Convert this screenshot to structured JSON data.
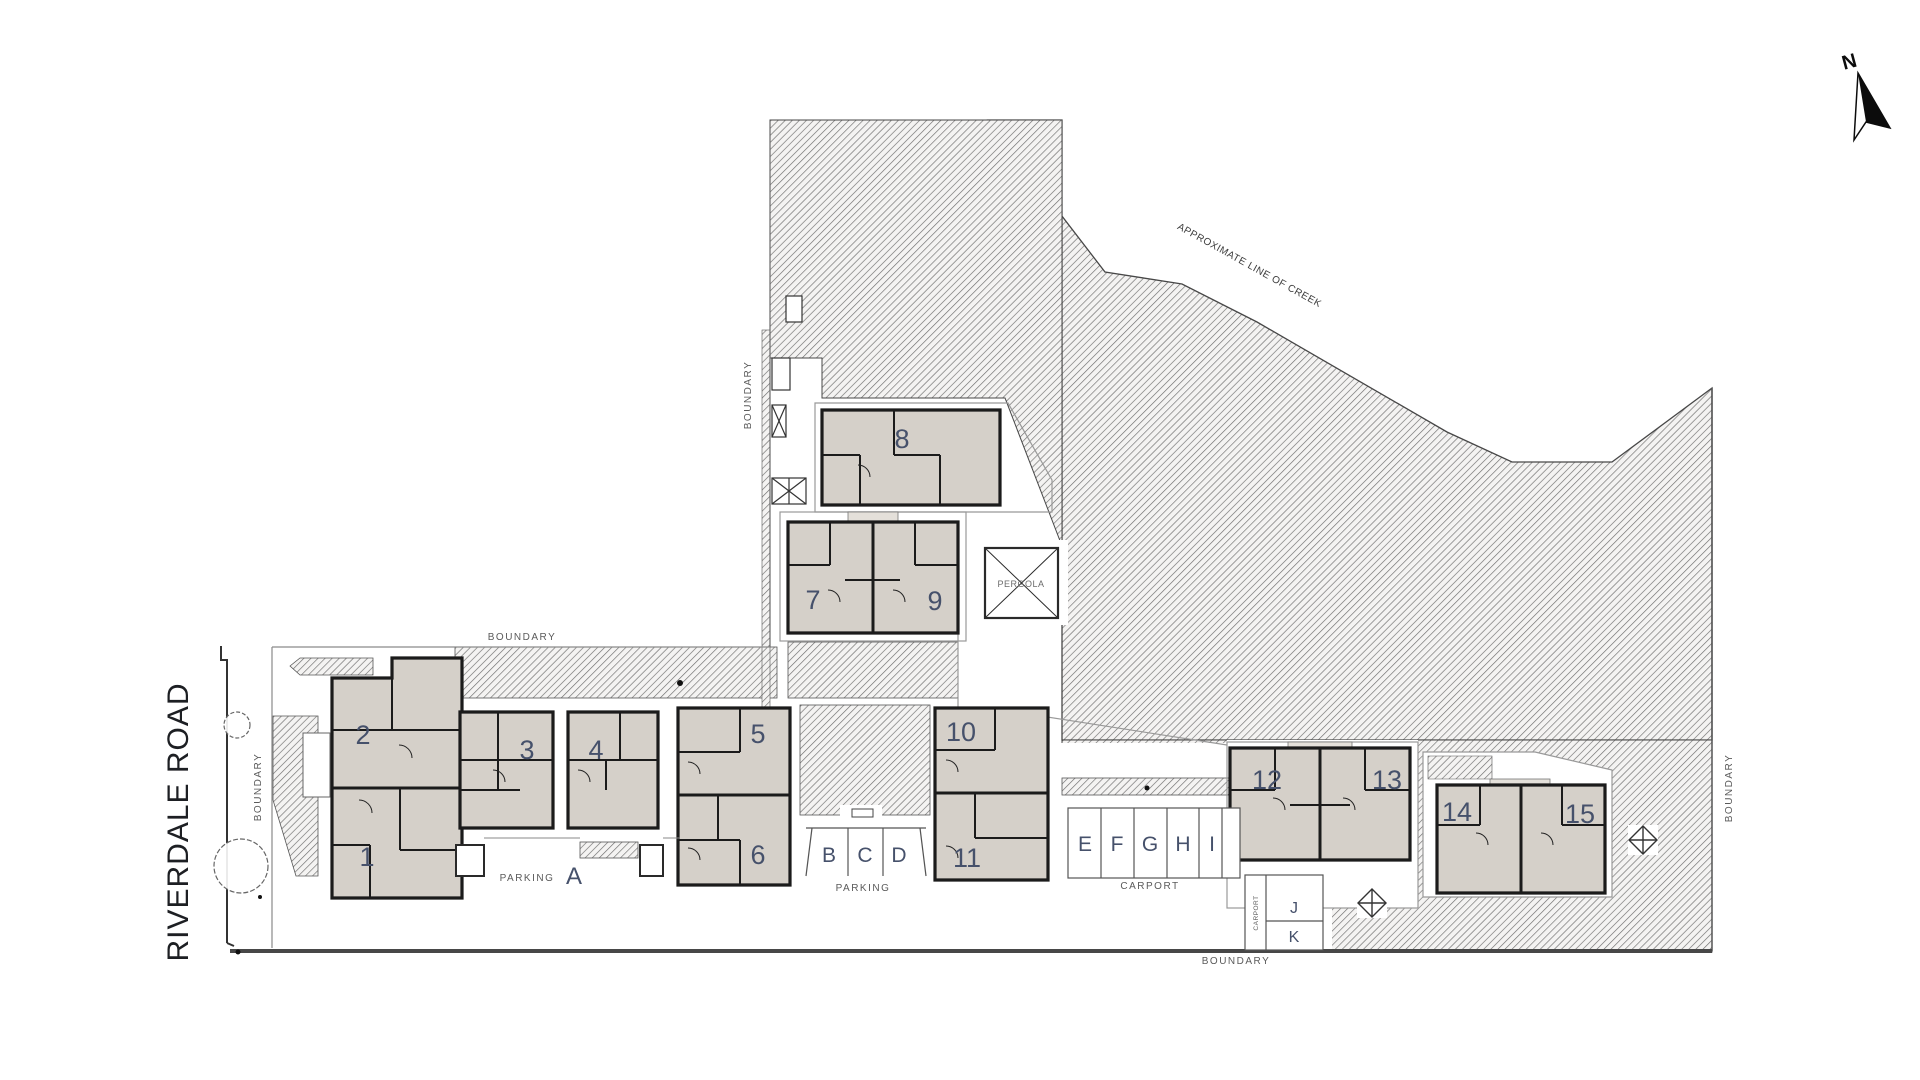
{
  "labels": {
    "road": "RIVERDALE ROAD",
    "boundary": "BOUNDARY",
    "creek": "APPROXIMATE LINE OF CREEK",
    "pergola": "PERGOLA",
    "parking": "PARKING",
    "carport": "CARPORT",
    "north": "N"
  },
  "units": [
    {
      "label": "1"
    },
    {
      "label": "2"
    },
    {
      "label": "3"
    },
    {
      "label": "4"
    },
    {
      "label": "5"
    },
    {
      "label": "6"
    },
    {
      "label": "7"
    },
    {
      "label": "8"
    },
    {
      "label": "9"
    },
    {
      "label": "10"
    },
    {
      "label": "11"
    },
    {
      "label": "12"
    },
    {
      "label": "13"
    },
    {
      "label": "14"
    },
    {
      "label": "15"
    }
  ],
  "parking_bays": {
    "row_a": [
      "A"
    ],
    "row_bcd": [
      "B",
      "C",
      "D"
    ],
    "row_ei": [
      "E",
      "F",
      "G",
      "H",
      "I"
    ],
    "row_jk": [
      "J",
      "K"
    ]
  },
  "colors": {
    "building_fill": "#d5d0c9",
    "building_light": "#e4e0da",
    "wall": "#1b1b1b",
    "hatch_bg": "#f4f3f2",
    "hatch_line": "#6e6e6e",
    "unit_number": "#46516b",
    "label_gray": "#5a5a5a"
  }
}
